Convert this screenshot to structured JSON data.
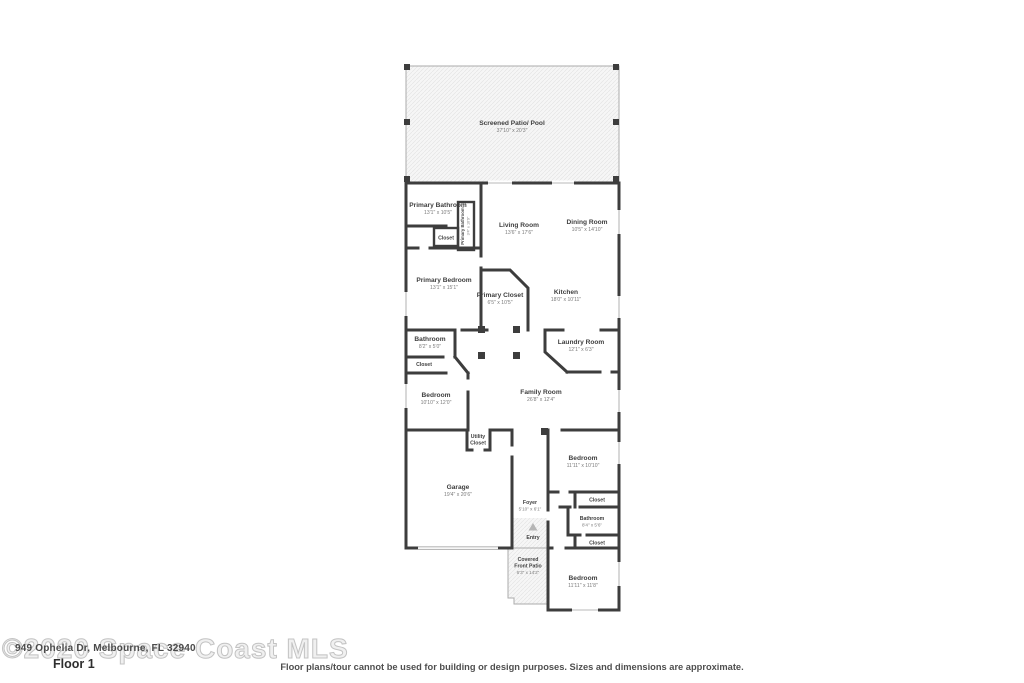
{
  "watermark": {
    "mls_text": "©2020 Space Coast MLS",
    "address": "949 Ophelia Dr, Melbourne, FL 32940"
  },
  "floor_label": "Floor 1",
  "disclaimer": "Floor plans/tour cannot be used for building or design purposes. Sizes and dimensions are approximate.",
  "rooms": {
    "screened_patio": {
      "name": "Screened Patio/ Pool",
      "dims": "37'10\" x 20'3\""
    },
    "primary_bathroom": {
      "name": "Primary Bathroom",
      "dims": "13'1\" x 10'5\""
    },
    "primary_bath_wc": {
      "name": "Primary Bathroom",
      "dims": "3'4\" x 10'9\""
    },
    "closet_primary": {
      "name": "Closet"
    },
    "living_room": {
      "name": "Living Room",
      "dims": "13'6\" x 17'6\""
    },
    "dining_room": {
      "name": "Dining Room",
      "dims": "10'5\" x 14'10\""
    },
    "primary_bedroom": {
      "name": "Primary Bedroom",
      "dims": "13'1\" x 15'1\""
    },
    "primary_closet": {
      "name": "Primary Closet",
      "dims": "6'5\" x 10'5\""
    },
    "kitchen": {
      "name": "Kitchen",
      "dims": "18'0\" x 10'11\""
    },
    "bathroom_1": {
      "name": "Bathroom",
      "dims": "8'2\" x 5'0\""
    },
    "closet_1": {
      "name": "Closet"
    },
    "laundry_room": {
      "name": "Laundry Room",
      "dims": "12'1\" x 6'3\""
    },
    "bedroom_1": {
      "name": "Bedroom",
      "dims": "10'10\" x 12'0\""
    },
    "family_room": {
      "name": "Family Room",
      "dims": "26'8\" x 12'4\""
    },
    "utility_closet": {
      "name_lines": [
        "Utility",
        "Closet"
      ]
    },
    "garage": {
      "name": "Garage",
      "dims": "19'4\" x 20'6\""
    },
    "foyer": {
      "name": "Foyer",
      "dims": "5'10\" x 6'1\""
    },
    "entry": {
      "name": "Entry"
    },
    "bedroom_2": {
      "name": "Bedroom",
      "dims": "11'11\" x 10'10\""
    },
    "closet_2": {
      "name": "Closet"
    },
    "bathroom_2": {
      "name": "Bathroom",
      "dims": "8'4\" x 5'6\""
    },
    "closet_3": {
      "name": "Closet"
    },
    "covered_front_patio": {
      "name_lines": [
        "Covered",
        "Front Patio"
      ],
      "dims": "6'3\" x 14'2\""
    },
    "bedroom_3": {
      "name": "Bedroom",
      "dims": "11'11\" x 11'8\""
    }
  }
}
